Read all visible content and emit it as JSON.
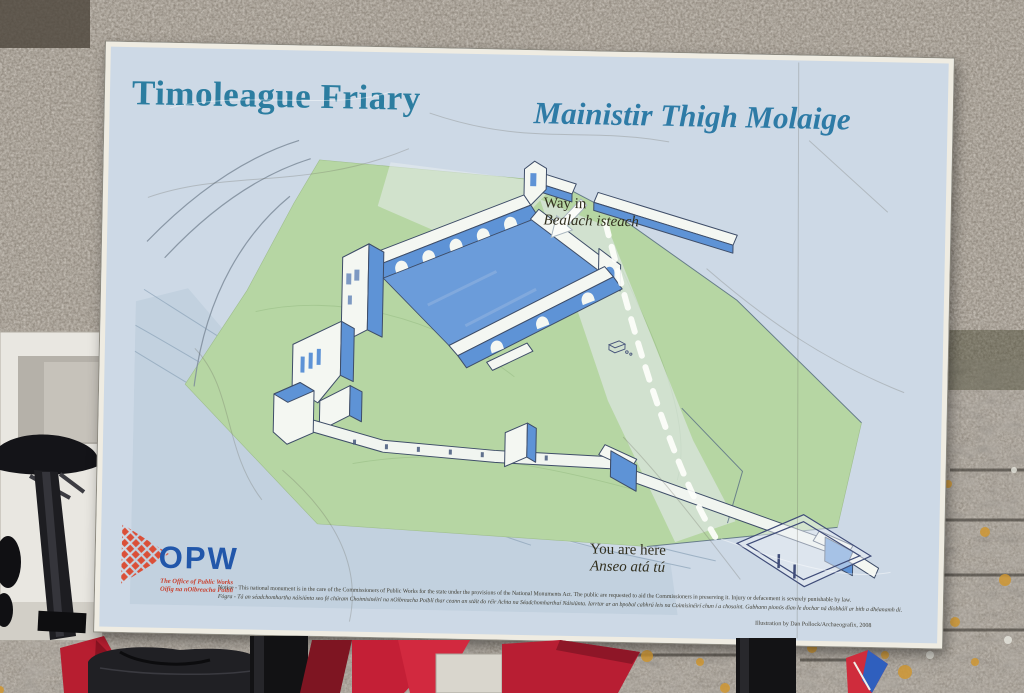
{
  "sign": {
    "title_en": "Timoleague Friary",
    "title_ga": "Mainistir Thigh Molaige",
    "map_labels": {
      "way_in_en": "Way in",
      "way_in_ga": "Bealach isteach",
      "you_are_here_en": "You are here",
      "you_are_here_ga": "Anseo atá tú"
    },
    "logo": {
      "acronym": "OPW",
      "name_en": "The Office of Public Works",
      "name_ga": "Oifig na nOibreacha Poiblí"
    },
    "notice_en": "Notice - This national monument is in the care of the Commissioners of Public Works for the state under the provisions of the National Monuments Act. The public are requested to aid the Commissioners in preserving it. Injury or defacement is severely punishable by law.",
    "notice_ga": "Fógra - Tá an séadchomhartha náisiúnta seo fé chúram Choimisinéirí na nOibreacha Poiblí thar ceann an stáit do réir Achta na Séadchomharthaí Náisiúnta. Iarrtar ar an bpobal cabhrú leis na Coimisinéirí chun í a chosaint. Gabhann pionós dian le dochar ná díobháil ar bith a dhéanamh di.",
    "credit": "Illustration by Dan Pollock/Archaeografix, 2008",
    "colors": {
      "panel": "#cdd9e6",
      "title_teal": "#2c7da0",
      "grass_green": "#b6d6a3",
      "building_shade_blue": "#5e93d6",
      "building_white": "#f4f7f2",
      "logo_red": "#da4f38",
      "logo_blue": "#2257aa"
    }
  }
}
